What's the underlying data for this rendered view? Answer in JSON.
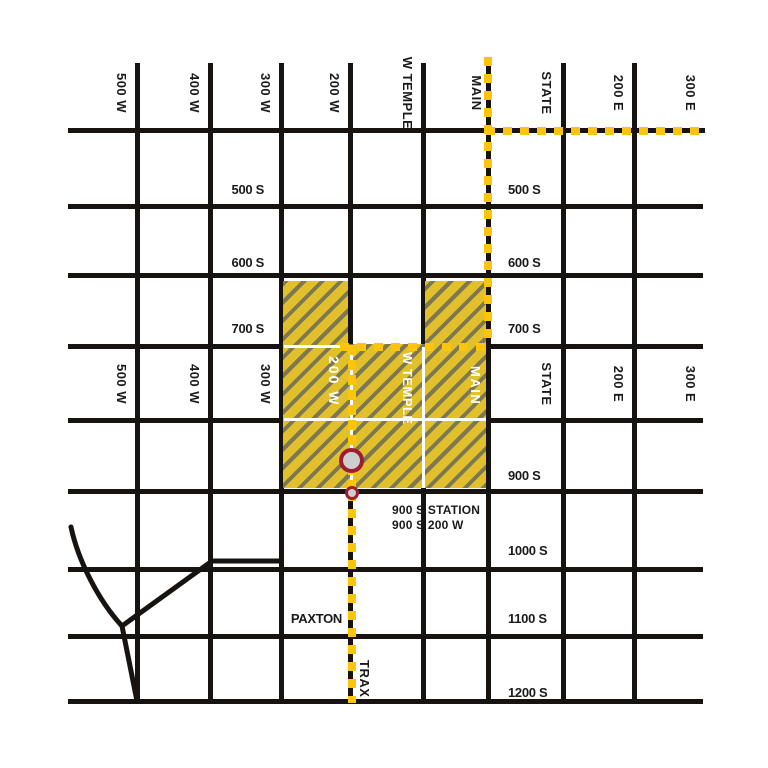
{
  "streets": {
    "w500": "500 W",
    "w400": "400 W",
    "w300": "300 W",
    "w200": "200 W",
    "wtemple": "W TEMPLE",
    "main": "MAIN",
    "state": "STATE",
    "e200": "200 E",
    "e300": "300 E",
    "s500": "500 S",
    "s600": "600 S",
    "s700": "700 S",
    "s900": "900 S",
    "s1000": "1000 S",
    "s1100": "1100 S",
    "s1200": "1200 S",
    "paxton": "PAXTON"
  },
  "route": {
    "name": "TRAX"
  },
  "station": {
    "line1": "900 S STATION",
    "line2": "900 S 200 W"
  },
  "colors": {
    "street": "#171310",
    "route_yellow": "#fcc40b",
    "hatch_yellow": "#e2c02b",
    "hatch_stripe": "#7c7952",
    "marker_ring": "#9e1e30",
    "marker_fill": "#cccfcf",
    "inner_street": "#ffffff"
  }
}
